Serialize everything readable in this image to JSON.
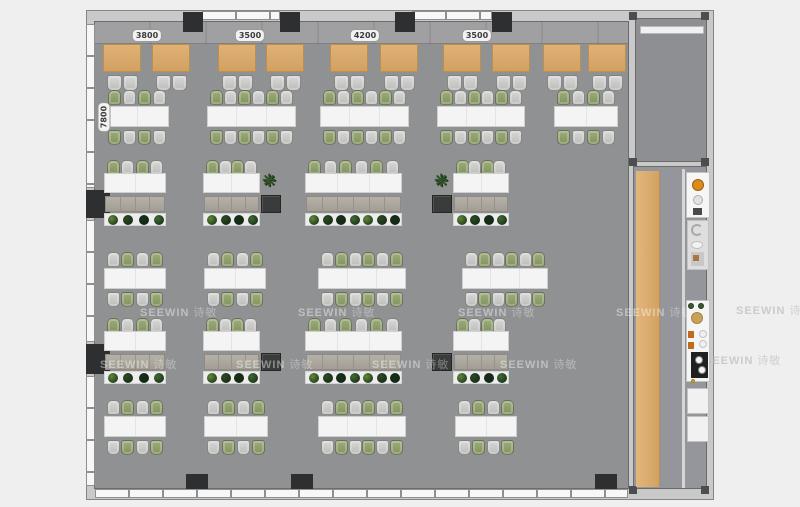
{
  "watermark": {
    "brand": "SEEWIN",
    "cjk": "诗敏"
  },
  "dimensions": {
    "top": [
      {
        "label": "3800",
        "cx": 147,
        "y": 29
      },
      {
        "label": "3500",
        "cx": 250,
        "y": 29
      },
      {
        "label": "4200",
        "cx": 365,
        "y": 29
      },
      {
        "label": "3500",
        "cx": 477,
        "y": 29
      }
    ],
    "left": [
      {
        "label": "7800",
        "cx": 104,
        "cy": 117
      }
    ]
  },
  "colors": {
    "page_bg": "#efefef",
    "floor": "#8f9193",
    "wall": "#c9c9c9",
    "column_dark": "#2d2f30",
    "window": "#f7f7f7",
    "booth_table": "#d8a96e",
    "chair_gray": "#c9c9c7",
    "chair_green": "#90a06e",
    "desk_white": "#f4f4f4",
    "cabinet": "#aba69d",
    "storage_dark": "#3a3c3c",
    "wood_bench": "#d8a96e",
    "accent_orange": "#df8a1c"
  },
  "floorplan": {
    "booths": {
      "y": 44,
      "w": 38,
      "h": 28,
      "xs": [
        103,
        152,
        218,
        266,
        330,
        380,
        443,
        492,
        543,
        588
      ]
    },
    "bench_rows": [
      {
        "y": 90,
        "start": "green",
        "tables": [
          {
            "x": 105,
            "w": 64,
            "seats": 4
          },
          {
            "x": 207,
            "w": 89,
            "seats": 6
          },
          {
            "x": 320,
            "w": 89,
            "seats": 6
          },
          {
            "x": 437,
            "w": 88,
            "seats": 6
          },
          {
            "x": 554,
            "w": 64,
            "seats": 4
          }
        ]
      },
      {
        "y": 252,
        "start": "gray",
        "tables": [
          {
            "x": 104,
            "w": 62,
            "seats": 4
          },
          {
            "x": 204,
            "w": 62,
            "seats": 4
          },
          {
            "x": 318,
            "w": 88,
            "seats": 6
          },
          {
            "x": 462,
            "w": 86,
            "seats": 6
          }
        ]
      },
      {
        "y": 400,
        "start": "gray",
        "tables": [
          {
            "x": 104,
            "w": 62,
            "seats": 4
          },
          {
            "x": 204,
            "w": 64,
            "seats": 4
          },
          {
            "x": 318,
            "w": 88,
            "seats": 6
          },
          {
            "x": 455,
            "w": 62,
            "seats": 4
          }
        ]
      }
    ],
    "work_rows": [
      {
        "y": 160,
        "start": "green",
        "groups": [
          {
            "x": 104,
            "w": 62,
            "seats": 4
          },
          {
            "x": 203,
            "w": 57,
            "seats": 4,
            "dark": "right",
            "pot": "right"
          },
          {
            "x": 305,
            "w": 97,
            "seats": 6
          },
          {
            "x": 453,
            "w": 56,
            "seats": 4,
            "dark": "left",
            "pot": "left"
          }
        ]
      },
      {
        "y": 318,
        "start": "green",
        "groups": [
          {
            "x": 104,
            "w": 62,
            "seats": 4
          },
          {
            "x": 203,
            "w": 57,
            "seats": 4,
            "dark": "right"
          },
          {
            "x": 305,
            "w": 97,
            "seats": 6
          },
          {
            "x": 453,
            "w": 56,
            "seats": 4,
            "dark": "left"
          }
        ]
      }
    ],
    "plant_colors": [
      "#5f8a3c",
      "#2c4a27",
      "#16301b",
      "#3f6b35"
    ],
    "watermarks_floor": [
      {
        "x": 140,
        "y": 304
      },
      {
        "x": 298,
        "y": 304
      },
      {
        "x": 458,
        "y": 304
      },
      {
        "x": 616,
        "y": 304
      },
      {
        "x": 100,
        "y": 356
      },
      {
        "x": 236,
        "y": 356
      },
      {
        "x": 372,
        "y": 356
      },
      {
        "x": 500,
        "y": 356
      }
    ],
    "watermarks_margin": [
      {
        "x": 736,
        "y": 302
      },
      {
        "x": 704,
        "y": 352
      }
    ],
    "pantry_items": [
      {
        "type": "panel",
        "x": 686,
        "y": 172,
        "w": 24,
        "h": 46,
        "fill": "#f6f6f6"
      },
      {
        "type": "circle",
        "cx": 698,
        "cy": 185,
        "r": 6,
        "fill": "#df8a1c",
        "ring": "#9a5f10"
      },
      {
        "type": "circle",
        "cx": 698,
        "cy": 200,
        "r": 5,
        "fill": "#e2e2e2",
        "ring": "#b0b0b0"
      },
      {
        "type": "rect",
        "x": 693,
        "y": 208,
        "w": 9,
        "h": 7,
        "fill": "#4a4a4a"
      },
      {
        "type": "panel",
        "x": 687,
        "y": 220,
        "w": 22,
        "h": 50,
        "fill": "#dedede"
      },
      {
        "type": "arc",
        "x": 691,
        "y": 224,
        "w": 12,
        "h": 12
      },
      {
        "type": "oval",
        "x": 691,
        "y": 241,
        "w": 12,
        "h": 8,
        "fill": "#f2f2f2"
      },
      {
        "type": "rect",
        "x": 691,
        "y": 252,
        "w": 13,
        "h": 14,
        "fill": "#c8c8c8"
      },
      {
        "type": "rect",
        "x": 693,
        "y": 255,
        "w": 6,
        "h": 6,
        "fill": "#a87840"
      },
      {
        "type": "panel",
        "x": 686,
        "y": 300,
        "w": 24,
        "h": 82,
        "fill": "#f5f5f5"
      },
      {
        "type": "circle",
        "cx": 691,
        "cy": 306,
        "r": 3,
        "fill": "#3c5a30",
        "ring": "#24381d"
      },
      {
        "type": "circle",
        "cx": 701,
        "cy": 306,
        "r": 3,
        "fill": "#3c5a30",
        "ring": "#24381d"
      },
      {
        "type": "circle",
        "cx": 697,
        "cy": 318,
        "r": 6,
        "fill": "#c8a258",
        "ring": "#a9843e"
      },
      {
        "type": "rect",
        "x": 688,
        "y": 331,
        "w": 6,
        "h": 7,
        "fill": "#c06a20"
      },
      {
        "type": "rect",
        "x": 688,
        "y": 342,
        "w": 6,
        "h": 7,
        "fill": "#c06a20"
      },
      {
        "type": "circle",
        "cx": 703,
        "cy": 334,
        "r": 4,
        "fill": "#efefef",
        "ring": "#c3c3c3"
      },
      {
        "type": "circle",
        "cx": 703,
        "cy": 344,
        "r": 4,
        "fill": "#efefef",
        "ring": "#c3c3c3"
      },
      {
        "type": "rect",
        "x": 691,
        "y": 352,
        "w": 17,
        "h": 26,
        "fill": "#202020"
      },
      {
        "type": "circle",
        "cx": 699,
        "cy": 360,
        "r": 4,
        "fill": "#f5f5f5",
        "ring": "#888888"
      },
      {
        "type": "circle",
        "cx": 702,
        "cy": 370,
        "r": 4,
        "fill": "#f5f5f5",
        "ring": "#888888"
      },
      {
        "type": "circle",
        "cx": 693,
        "cy": 381,
        "r": 2,
        "fill": "#e0b020",
        "ring": "#a8820c"
      },
      {
        "type": "panel",
        "x": 687,
        "y": 388,
        "w": 22,
        "h": 26,
        "fill": "#f1f1f1"
      },
      {
        "type": "panel",
        "x": 687,
        "y": 416,
        "w": 22,
        "h": 26,
        "fill": "#f1f1f1"
      }
    ]
  }
}
